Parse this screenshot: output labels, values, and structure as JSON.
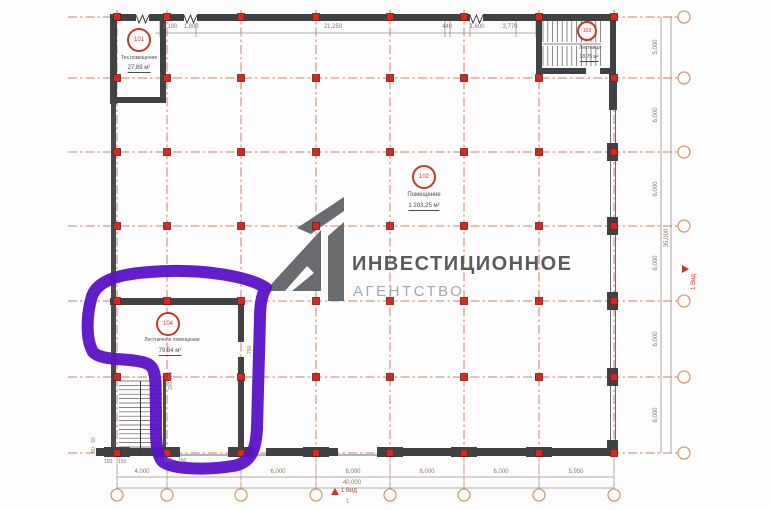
{
  "plan": {
    "watermark": {
      "line1": "ИНВЕСТИЦИОННОЕ",
      "line2": "АГЕНТСТВО"
    },
    "rooms": {
      "r101": {
        "number": "101",
        "name": "Тех.помещение",
        "area": "27,89 м²"
      },
      "r102": {
        "number": "102",
        "name": "Помещение",
        "area": "1 203,25 м²"
      },
      "r103": {
        "number": "103",
        "name": "Лестница",
        "area": "18,75 м²"
      },
      "r104": {
        "number": "104",
        "name": "Лестничное помещение",
        "area": "79,84 м²"
      }
    },
    "dims": {
      "top": {
        "d1": "1,100",
        "d2": "1,800",
        "d3": "21,250",
        "d4": "440",
        "d5": "1,600",
        "d6": "3,770"
      },
      "bottom": {
        "d1": "4,000",
        "d2": "6,000",
        "d3": "6,000",
        "d4": "6,000",
        "d5": "6,000",
        "d6": "5,950",
        "total": "40,000"
      },
      "right": {
        "d1": "5,000",
        "d2": "6,000",
        "d3": "6,000",
        "d4": "6,000",
        "d5": "6,000",
        "d6": "6,000",
        "total": "35,000"
      },
      "small": {
        "a": "150",
        "b": "150",
        "c": "150",
        "d": "150",
        "e": "50",
        "f": "50",
        "g": "750",
        "h": "200,100"
      }
    },
    "view_marker": {
      "label": "1 Вид",
      "number": "1"
    },
    "colors": {
      "grid_line": "#d08064",
      "grid_marker": "#cf2b24",
      "wall": "#3f4142",
      "annotation": "#5912c6",
      "logo": "#696b6e",
      "watermark_primary": "#5a5b5e",
      "watermark_secondary": "#a7a8ac"
    }
  }
}
